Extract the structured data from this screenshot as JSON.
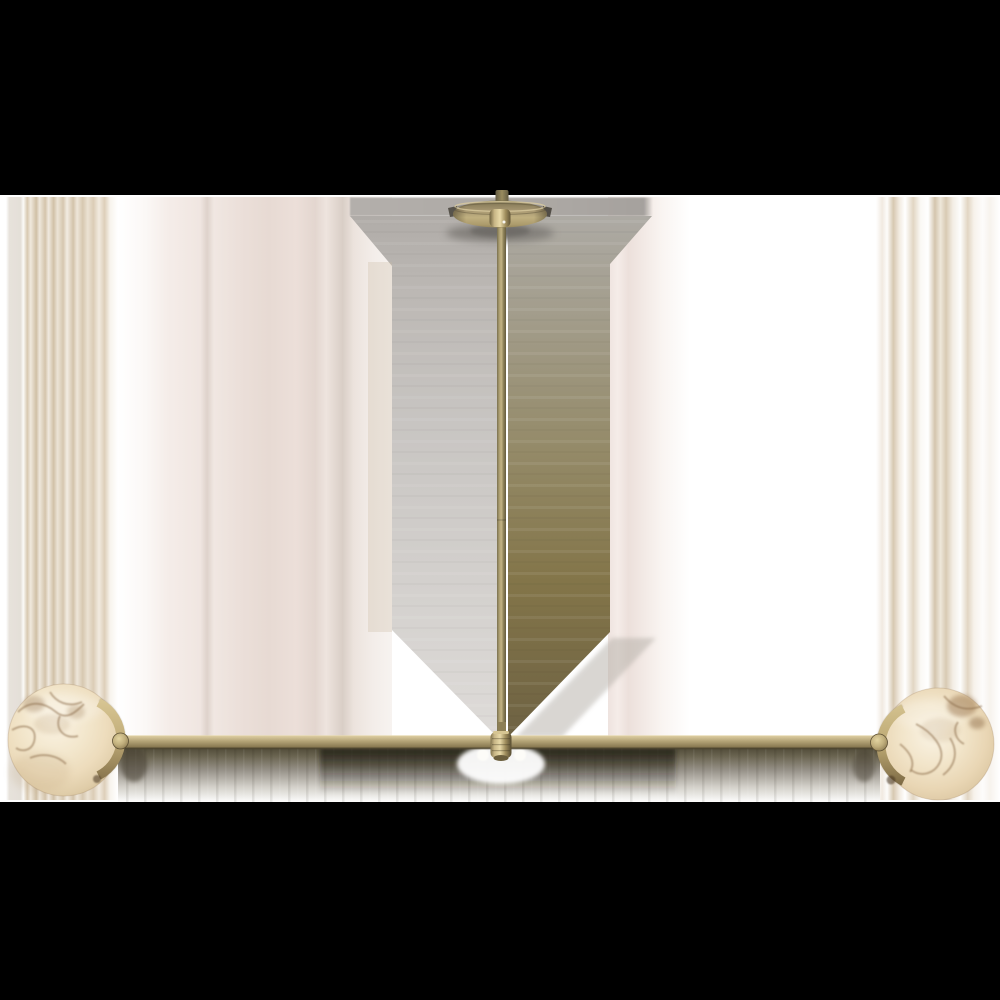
{
  "image": {
    "kind": "product-photograph",
    "subject": "two-light linear chandelier with alabaster globes and antique brass frame",
    "letterboxed": true
  },
  "colors": {
    "letterbox": "#000000",
    "canvas_white": "#ffffff",
    "brass_mid": "#b2a274",
    "brass_highlight": "#dcCC9e",
    "brass_shadow": "#6f6443",
    "alabaster_base": "#f0e2c6",
    "alabaster_vein": "#8a6a45",
    "smear_tan": "#d5c6af",
    "smear_blush": "#ecdfda",
    "smear_gray": "#c6c3c0",
    "smear_olive": "#82764d",
    "under_bar_shadow": "#514c39"
  },
  "parts": {
    "canopy": "ceiling-canopy",
    "stem": "downrod",
    "crossbar": "horizontal-arm",
    "connector": "center-swivel",
    "globe_left": "alabaster-globe-left",
    "globe_right": "alabaster-globe-right",
    "bracket_left": "brass-cradle-left",
    "bracket_right": "brass-cradle-right"
  }
}
